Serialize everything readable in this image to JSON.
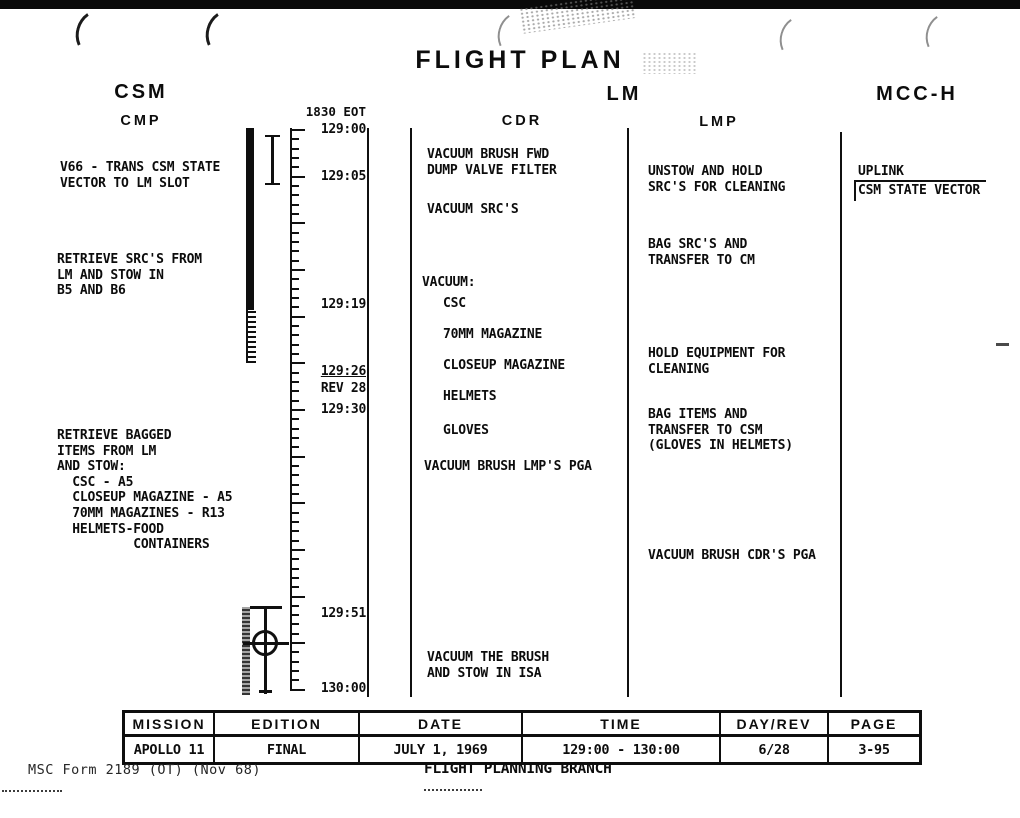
{
  "page": {
    "title": "FLIGHT PLAN",
    "form_number": "MSC Form 2189 (OT) (Nov 68)",
    "footer_org": "FLIGHT PLANNING BRANCH"
  },
  "columns": {
    "csm_title": "CSM",
    "cmp_header": "CMP",
    "lm_title": "LM",
    "cdr_header": "CDR",
    "lmp_header": "LMP",
    "mcc_title": "MCC-H"
  },
  "timeline": {
    "eot_label": "1830 EOT",
    "start_min": 0,
    "end_min": 60,
    "top_y": 129,
    "px_per_min": 9.33,
    "major_every": 5,
    "labels": [
      {
        "text": "129:00",
        "y": 130
      },
      {
        "text": "129:05",
        "y": 177
      },
      {
        "text": "129:19",
        "y": 305
      },
      {
        "text": "129:26",
        "y": 372,
        "underline": true
      },
      {
        "text": "REV 28",
        "y": 389
      },
      {
        "text": "129:30",
        "y": 410
      },
      {
        "text": "129:51",
        "y": 614
      },
      {
        "text": "130:00",
        "y": 689
      }
    ]
  },
  "cmp": {
    "activities": [
      {
        "text": "V66 - TRANS CSM STATE\nVECTOR TO LM SLOT"
      },
      {
        "text": "RETRIEVE SRC'S FROM\nLM AND STOW IN\nB5 AND B6"
      },
      {
        "text": "RETRIEVE BAGGED\nITEMS FROM LM\nAND STOW:\n  CSC - A5\n  CLOSEUP MAGAZINE - A5\n  70MM MAGAZINES - R13\n  HELMETS-FOOD\n          CONTAINERS"
      }
    ]
  },
  "cdr": {
    "activities": [
      {
        "text": "VACUUM BRUSH FWD\nDUMP VALVE FILTER"
      },
      {
        "text": "VACUUM SRC'S"
      },
      {
        "text": "VACUUM:"
      },
      {
        "text": "CSC"
      },
      {
        "text": "70MM MAGAZINE"
      },
      {
        "text": "CLOSEUP MAGAZINE"
      },
      {
        "text": "HELMETS"
      },
      {
        "text": "GLOVES"
      },
      {
        "text": "VACUUM BRUSH LMP'S PGA"
      },
      {
        "text": "VACUUM THE BRUSH\nAND STOW IN ISA"
      }
    ]
  },
  "lmp": {
    "activities": [
      {
        "text": "UNSTOW AND HOLD\nSRC'S FOR CLEANING"
      },
      {
        "text": "BAG SRC'S AND\nTRANSFER TO CM"
      },
      {
        "text": "HOLD EQUIPMENT FOR\nCLEANING"
      },
      {
        "text": "BAG ITEMS AND\nTRANSFER TO CSM\n(GLOVES IN HELMETS)"
      },
      {
        "text": "VACUUM BRUSH CDR'S PGA"
      }
    ]
  },
  "mcc": {
    "uplink_label": "UPLINK",
    "uplink_item": "CSM STATE VECTOR"
  },
  "footer_table": {
    "headers": [
      "MISSION",
      "EDITION",
      "DATE",
      "TIME",
      "DAY/REV",
      "PAGE"
    ],
    "values": [
      "APOLLO 11",
      "FINAL",
      "JULY 1, 1969",
      "129:00 - 130:00",
      "6/28",
      "3-95"
    ]
  },
  "colors": {
    "ink": "#0d0d0d",
    "paper": "#ffffff"
  }
}
